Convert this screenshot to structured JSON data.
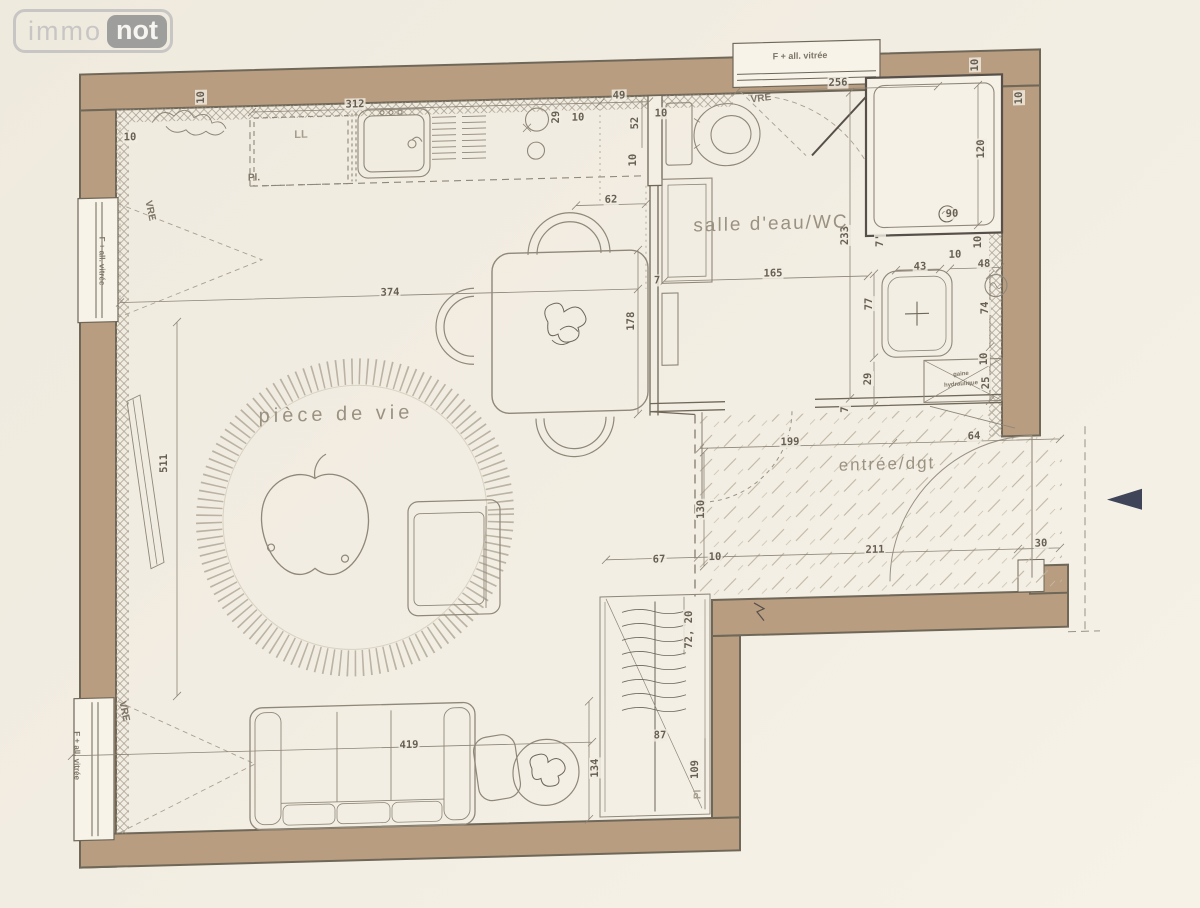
{
  "logo": {
    "immo": "immo",
    "not": "not"
  },
  "colors": {
    "paper": "#f2ede2",
    "wall": "#b89d80",
    "wall_edge": "#6f6758",
    "partition_line": "#7b7365",
    "furniture_line": "#8f8778",
    "dimension_line": "#8c8476",
    "fixture_dark": "#57504a",
    "text": "#675f52",
    "room_text": "#9a9181",
    "entry_arrow": "#3f4459"
  },
  "plan": {
    "rooms": [
      {
        "name": "room-label-living",
        "label": "pièce de vie",
        "x": 336,
        "y": 409,
        "size": 20,
        "ls": 4
      },
      {
        "name": "room-label-bathroom",
        "label": "salle d'eau/WC",
        "x": 771,
        "y": 230,
        "size": 19,
        "ls": 2
      },
      {
        "name": "room-label-entry",
        "label": "entrée/dgt",
        "x": 887,
        "y": 473,
        "size": 17,
        "ls": 2
      }
    ],
    "annotations": [
      {
        "name": "window-label-top",
        "text": "F + all. vitrée",
        "x": 800,
        "y": 62,
        "size": 9,
        "rot": 0
      },
      {
        "name": "window-label-left-upper",
        "text": "F + all. vitrée",
        "x": 102,
        "y": 249,
        "size": 8,
        "rot": 90
      },
      {
        "name": "window-label-left-lower",
        "text": "F + all. vitrée",
        "x": 77,
        "y": 743,
        "size": 8,
        "rot": 90
      },
      {
        "name": "shutter-label-top",
        "text": "VRE",
        "x": 761,
        "y": 104,
        "size": 10,
        "rot": -6
      },
      {
        "name": "shutter-label-left-upper",
        "text": "VRE",
        "x": 150,
        "y": 200,
        "size": 10,
        "rot": 78
      },
      {
        "name": "shutter-label-left-lower",
        "text": "VRE",
        "x": 124,
        "y": 700,
        "size": 10,
        "rot": 78
      },
      {
        "name": "washing-machine-label",
        "text": "LL",
        "x": 301,
        "y": 128,
        "size": 11,
        "rot": 0,
        "cls": "ann-dashed"
      },
      {
        "name": "kitchen-closet-label",
        "text": "Pl.",
        "x": 254,
        "y": 170,
        "size": 10,
        "rot": 0
      },
      {
        "name": "entry-closet-label",
        "text": "Pl",
        "x": 698,
        "y": 798,
        "size": 10,
        "rot": -90,
        "cls": "ann-dashed"
      },
      {
        "name": "duct-label-line1",
        "text": "gaine",
        "x": 961,
        "y": 385,
        "size": 6,
        "rot": -3
      },
      {
        "name": "duct-label-line2",
        "text": "hydraulique",
        "x": 961,
        "y": 395,
        "size": 6,
        "rot": -3
      }
    ],
    "dimensions": [
      {
        "text": "312",
        "x": 355,
        "y": 99
      },
      {
        "text": "49",
        "x": 619,
        "y": 97
      },
      {
        "text": "29",
        "x": 556,
        "y": 117,
        "rot": -90
      },
      {
        "text": "10",
        "x": 578,
        "y": 118
      },
      {
        "text": "52",
        "x": 635,
        "y": 125,
        "rot": -90
      },
      {
        "text": "10",
        "x": 661,
        "y": 116
      },
      {
        "text": "10",
        "x": 633,
        "y": 162,
        "rot": -90
      },
      {
        "text": "62",
        "x": 611,
        "y": 201
      },
      {
        "text": "256",
        "x": 838,
        "y": 90
      },
      {
        "text": "10",
        "x": 975,
        "y": 76,
        "rot": -90
      },
      {
        "text": "10",
        "x": 1019,
        "y": 110,
        "rot": -90
      },
      {
        "text": "120",
        "x": 981,
        "y": 160,
        "rot": -90
      },
      {
        "text": "90",
        "x": 952,
        "y": 224
      },
      {
        "text": "10",
        "x": 978,
        "y": 253,
        "rot": -90
      },
      {
        "text": "10",
        "x": 955,
        "y": 265
      },
      {
        "text": "233",
        "x": 845,
        "y": 243,
        "rot": -90
      },
      {
        "text": "165",
        "x": 773,
        "y": 279
      },
      {
        "text": "7",
        "x": 657,
        "y": 283
      },
      {
        "text": "178",
        "x": 631,
        "y": 323,
        "rot": -90
      },
      {
        "text": "374",
        "x": 390,
        "y": 288
      },
      {
        "text": "43",
        "x": 920,
        "y": 276
      },
      {
        "text": "48",
        "x": 984,
        "y": 275
      },
      {
        "text": "77",
        "x": 869,
        "y": 312,
        "rot": -90
      },
      {
        "text": "74",
        "x": 985,
        "y": 319,
        "rot": -90
      },
      {
        "text": "29",
        "x": 868,
        "y": 387,
        "rot": -90
      },
      {
        "text": "10",
        "x": 984,
        "y": 370,
        "rot": -90
      },
      {
        "text": "25",
        "x": 986,
        "y": 394,
        "rot": -90
      },
      {
        "text": "7",
        "x": 845,
        "y": 417,
        "rot": -90
      },
      {
        "text": "64",
        "x": 974,
        "y": 447
      },
      {
        "text": "199",
        "x": 790,
        "y": 448
      },
      {
        "text": "130",
        "x": 701,
        "y": 513,
        "rot": -90
      },
      {
        "text": "67",
        "x": 659,
        "y": 562
      },
      {
        "text": "10",
        "x": 715,
        "y": 561
      },
      {
        "text": "211",
        "x": 875,
        "y": 558
      },
      {
        "text": "30",
        "x": 1041,
        "y": 556
      },
      {
        "text": "72, 20",
        "x": 689,
        "y": 633,
        "rot": -90
      },
      {
        "text": "419",
        "x": 409,
        "y": 741
      },
      {
        "text": "134",
        "x": 595,
        "y": 769,
        "rot": -90
      },
      {
        "text": "87",
        "x": 660,
        "y": 738
      },
      {
        "text": "109",
        "x": 695,
        "y": 773,
        "rot": -90
      },
      {
        "text": "511",
        "x": 164,
        "y": 453,
        "rot": -90
      },
      {
        "text": "10",
        "x": 130,
        "y": 126
      },
      {
        "text": "10",
        "x": 201,
        "y": 88,
        "rot": -90
      },
      {
        "text": "7'",
        "x": 880,
        "y": 249,
        "rot": -90
      }
    ]
  }
}
